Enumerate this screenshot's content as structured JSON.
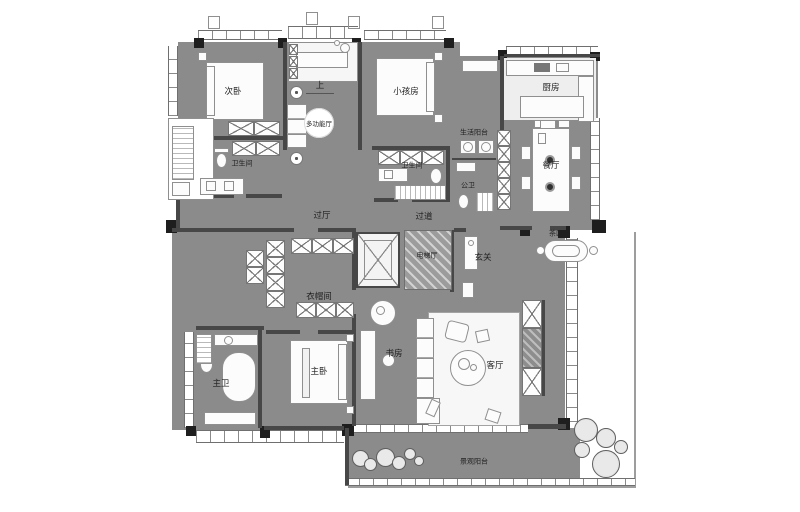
{
  "type": "architectural-floor-plan",
  "palette": {
    "floor_gray": "#8b8b8b",
    "wall_dark": "#474747",
    "column_black": "#1e1e1e",
    "furniture_white": "#fcfcfc",
    "paper_white": "#ffffff"
  },
  "rooms": [
    {
      "id": "secondary-bedroom",
      "label": "次卧"
    },
    {
      "id": "kids-room",
      "label": "小孩房"
    },
    {
      "id": "multi-function-hall",
      "label": "多功能厅"
    },
    {
      "id": "stair-up",
      "label": "上"
    },
    {
      "id": "bathroom-left",
      "label": "卫生间"
    },
    {
      "id": "bathroom-right",
      "label": "卫生间"
    },
    {
      "id": "pass-hall",
      "label": "过厅"
    },
    {
      "id": "corridor",
      "label": "过道"
    },
    {
      "id": "service-balcony",
      "label": "生活阳台"
    },
    {
      "id": "kitchen",
      "label": "厨房"
    },
    {
      "id": "guest-wc",
      "label": "公卫"
    },
    {
      "id": "dining-room",
      "label": "餐厅"
    },
    {
      "id": "elevator-hall",
      "label": "电梯厅"
    },
    {
      "id": "foyer",
      "label": "玄关"
    },
    {
      "id": "tea-area",
      "label": "茶区"
    },
    {
      "id": "walk-in-closet",
      "label": "衣帽间"
    },
    {
      "id": "master-bedroom",
      "label": "主卧"
    },
    {
      "id": "master-bathroom",
      "label": "主卫"
    },
    {
      "id": "study",
      "label": "书房"
    },
    {
      "id": "living-room",
      "label": "客厅"
    },
    {
      "id": "view-balcony",
      "label": "景观阳台"
    }
  ]
}
